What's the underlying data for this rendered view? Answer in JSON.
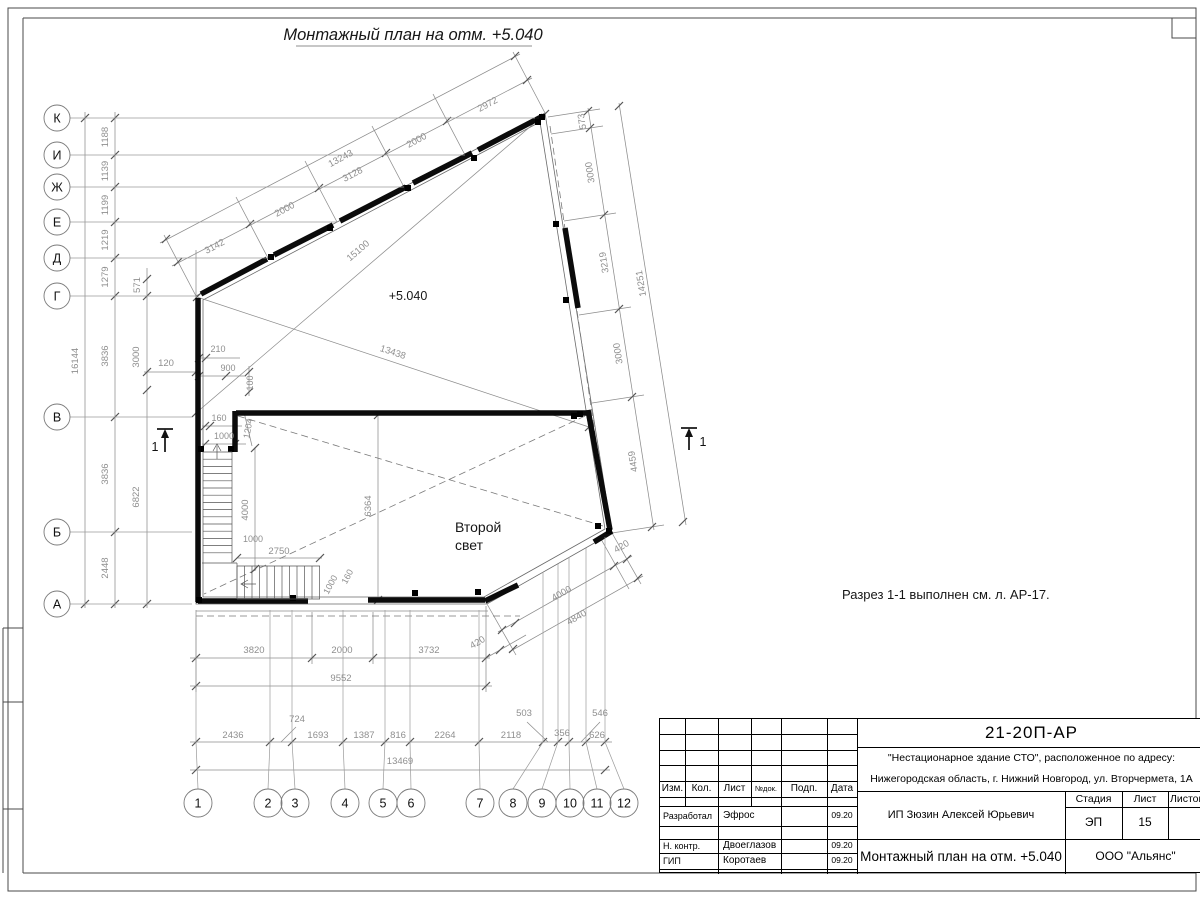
{
  "sheet": {
    "title": "Монтажный план на отм. +5.040",
    "note": "Разрез 1-1 выполнен см. л. АР-17.",
    "level": "+5.040",
    "room_line1": "Второй",
    "room_line2": "свет",
    "section_mark": "1"
  },
  "axes": {
    "left": [
      "К",
      "И",
      "Ж",
      "Е",
      "Д",
      "Г",
      "В",
      "Б",
      "А"
    ],
    "bottom": [
      "1",
      "2",
      "3",
      "4",
      "5",
      "6",
      "7",
      "8",
      "9",
      "10",
      "11",
      "12"
    ]
  },
  "dims": {
    "left_overall": "16144",
    "lk1": "1188",
    "lk2": "1139",
    "lk3": "1199",
    "lk4": "1219",
    "lk5": "1279",
    "lg1": "3836",
    "lg2": "3836",
    "lg3": "2448",
    "li1": "571",
    "li2": "3000",
    "li3": "6822",
    "li4": "120",
    "t1": "3142",
    "t2": "2000",
    "t3": "3128",
    "t4": "2000",
    "t5": "2972",
    "t_all": "13243",
    "r1": "573",
    "r2": "3000",
    "r3": "3219",
    "r4": "3000",
    "r5": "4459",
    "r420": "420",
    "r_all": "14251",
    "d1": "15100",
    "d2": "13438",
    "br1": "4000",
    "br2": "4840",
    "b1": "3820",
    "b2": "2000",
    "b3": "3732",
    "b420": "420",
    "b_all": "9552",
    "g1": "2436",
    "g2": "724",
    "g3": "1693",
    "g4": "1387",
    "g5": "816",
    "g6": "2264",
    "g7": "2118",
    "g8": "503",
    "g9": "356",
    "g10": "546",
    "g11": "626",
    "g_all": "13469",
    "i210": "210",
    "i900": "900",
    "i100": "100",
    "i160a": "160",
    "i1000a": "1000",
    "i1204": "1204",
    "i4000": "4000",
    "i1000b": "1000",
    "i2750": "2750",
    "i6364": "6364",
    "i1000c": "1000",
    "i160b": "160"
  },
  "titleblock": {
    "doc_code": "21-20П-АР",
    "project_line1": "\"Нестационарное здание СТО\", расположенное по адресу:",
    "project_line2": "Нижегородская область, г. Нижний Новгород, ул. Вторчермета, 1А",
    "client": "ИП Зюзин Алексей Юрьевич",
    "drawing_title": "Монтажный план на отм. +5.040",
    "company": "ООО \"Альянс\"",
    "stage_label": "Стадия",
    "sheet_label": "Лист",
    "sheets_label": "Листов",
    "stage": "ЭП",
    "sheet_number": "15",
    "header": {
      "izm": "Изм.",
      "kol": "Кол.",
      "list": "Лист",
      "ndok": "№док.",
      "podp": "Подп.",
      "data": "Дата"
    },
    "rows": [
      {
        "role": "Разработал",
        "name": "Эфрос",
        "date": "09.20"
      },
      {
        "role": "Н. контр.",
        "name": "Двоеглазов",
        "date": "09.20"
      },
      {
        "role": "ГИП",
        "name": "Коротаев",
        "date": "09.20"
      }
    ]
  }
}
